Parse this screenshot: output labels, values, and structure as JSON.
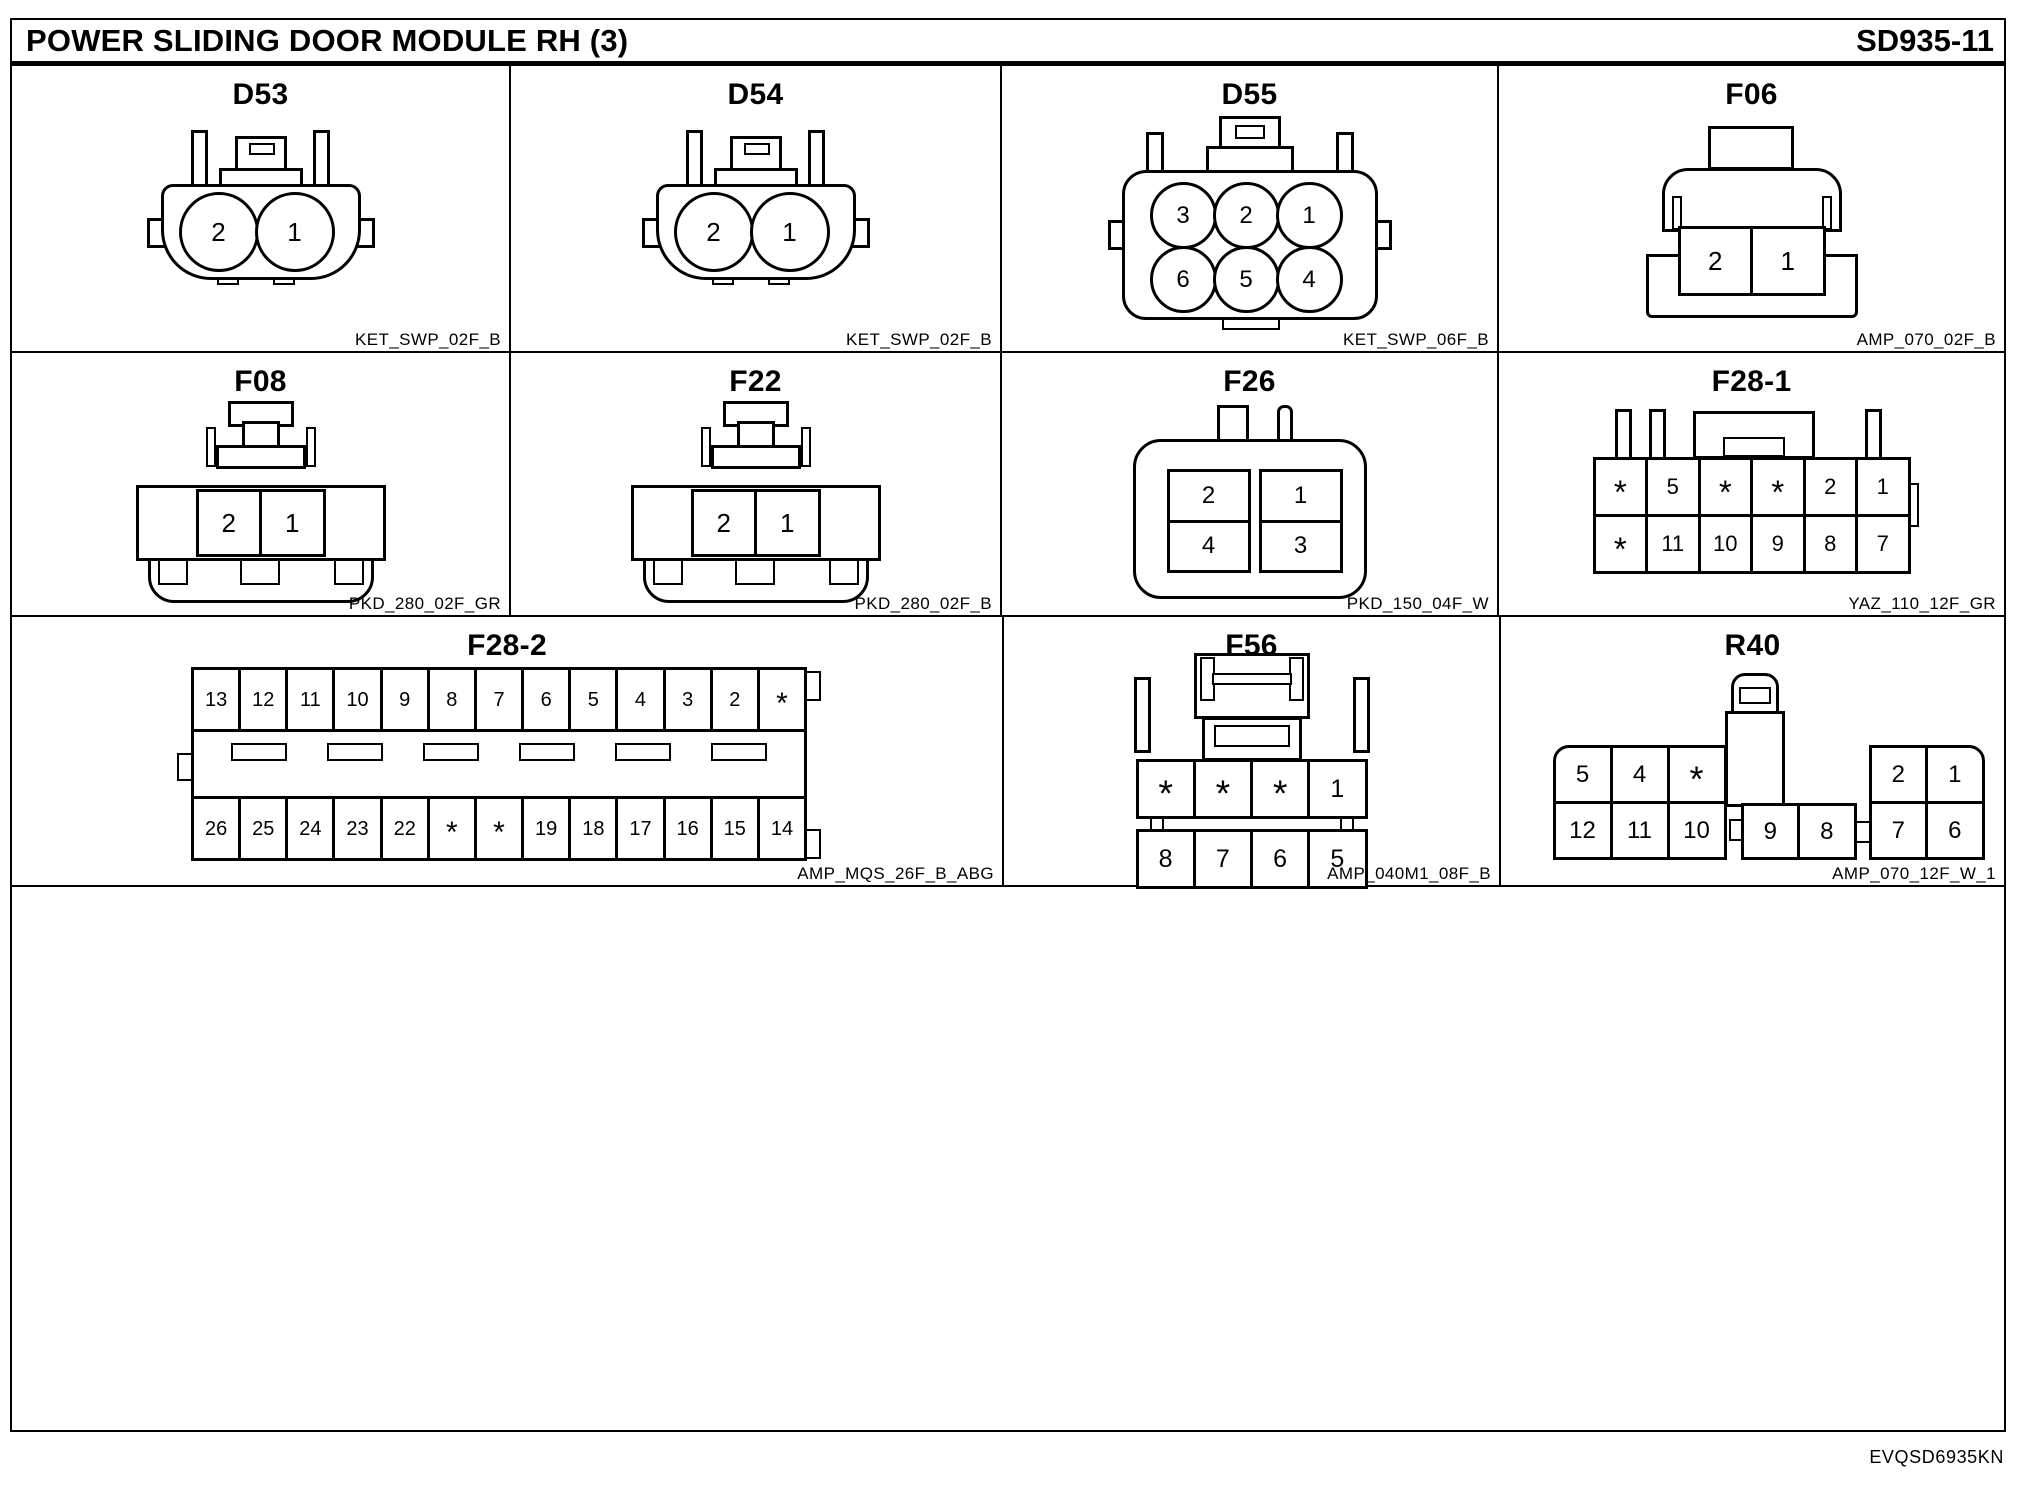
{
  "header": {
    "title": "POWER SLIDING DOOR MODULE RH (3)",
    "code": "SD935-11"
  },
  "footer": {
    "code": "EVQSD6935KN"
  },
  "ink_color": "#000000",
  "paper_color": "#ffffff",
  "connectors": {
    "d53": {
      "label": "D53",
      "part": "KET_SWP_02F_B",
      "pins": [
        "2",
        "1"
      ]
    },
    "d54": {
      "label": "D54",
      "part": "KET_SWP_02F_B",
      "pins": [
        "2",
        "1"
      ]
    },
    "d55": {
      "label": "D55",
      "part": "KET_SWP_06F_B",
      "row1": [
        "3",
        "2",
        "1"
      ],
      "row2": [
        "6",
        "5",
        "4"
      ]
    },
    "f06": {
      "label": "F06",
      "part": "AMP_070_02F_B",
      "pins": [
        "2",
        "1"
      ]
    },
    "f08": {
      "label": "F08",
      "part": "PKD_280_02F_GR",
      "pins": [
        "2",
        "1"
      ]
    },
    "f22": {
      "label": "F22",
      "part": "PKD_280_02F_B",
      "pins": [
        "2",
        "1"
      ]
    },
    "f26": {
      "label": "F26",
      "part": "PKD_150_04F_W",
      "col_left": [
        "2",
        "4"
      ],
      "col_right": [
        "1",
        "3"
      ]
    },
    "f28_1": {
      "label": "F28-1",
      "part": "YAZ_110_12F_GR",
      "row1": [
        "*",
        "5",
        "*",
        "*",
        "2",
        "1"
      ],
      "row2": [
        "*",
        "11",
        "10",
        "9",
        "8",
        "7"
      ]
    },
    "f28_2": {
      "label": "F28-2",
      "part": "AMP_MQS_26F_B_ABG",
      "row1": [
        "13",
        "12",
        "11",
        "10",
        "9",
        "8",
        "7",
        "6",
        "5",
        "4",
        "3",
        "2",
        "*"
      ],
      "row2": [
        "26",
        "25",
        "24",
        "23",
        "22",
        "*",
        "*",
        "19",
        "18",
        "17",
        "16",
        "15",
        "14"
      ]
    },
    "f56": {
      "label": "F56",
      "part": "AMP_040M1_08F_B",
      "row1": [
        "*",
        "*",
        "*",
        "1"
      ],
      "row2": [
        "8",
        "7",
        "6",
        "5"
      ]
    },
    "r40": {
      "label": "R40",
      "part": "AMP_070_12F_W_1",
      "left_top": [
        "5",
        "4",
        "*"
      ],
      "left_bottom": [
        "12",
        "11",
        "10"
      ],
      "mid_bottom": [
        "9",
        "8"
      ],
      "right_top": [
        "2",
        "1"
      ],
      "right_bottom": [
        "7",
        "6"
      ]
    }
  }
}
